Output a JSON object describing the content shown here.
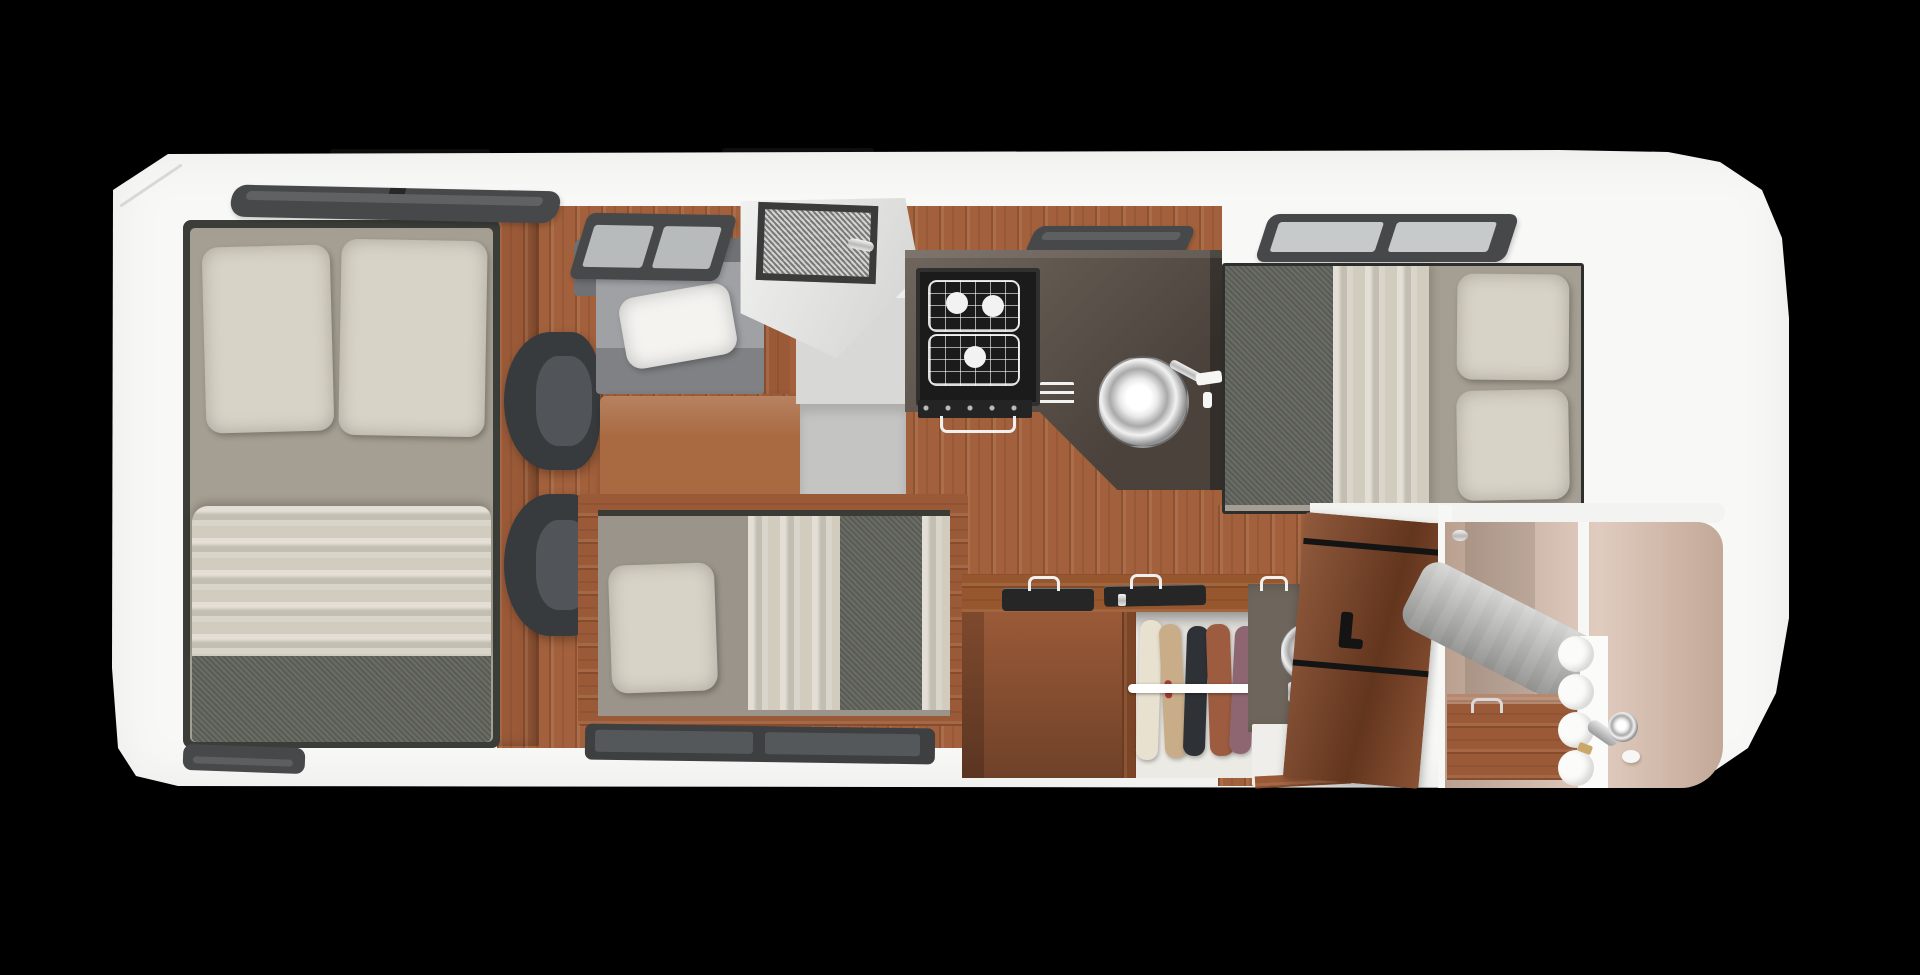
{
  "scene": {
    "description": "Top-down 3D rendered floor plan of a Class-C RV motorhome interior on a black background",
    "vehicle": "rv-motorhome-floorplan",
    "rooms": [
      {
        "name": "master-bedroom",
        "contains": [
          "double-bed",
          "two-pillows",
          "duvet",
          "blanket",
          "wood-partition",
          "window"
        ]
      },
      {
        "name": "dinette-lounge",
        "contains": [
          "sofa-bench",
          "white-pillow",
          "wood-table",
          "two-armchairs",
          "window"
        ]
      },
      {
        "name": "entry",
        "contains": [
          "entry-door",
          "screen-window",
          "door-handle",
          "step-well"
        ]
      },
      {
        "name": "kitchen",
        "contains": [
          "l-shaped-counter",
          "three-burner-stove",
          "oven-handle",
          "towel-rack",
          "round-sink",
          "faucet",
          "window"
        ]
      },
      {
        "name": "rear-bedroom",
        "contains": [
          "double-bed",
          "two-pillows",
          "duvet",
          "blanket",
          "window"
        ]
      },
      {
        "name": "sofa-bed-nook",
        "contains": [
          "single-bed",
          "pillow",
          "duvet",
          "blanket",
          "wood-frame",
          "window"
        ]
      },
      {
        "name": "storage",
        "contains": [
          "counter-block",
          "two-storage-trays",
          "wire-handles",
          "wardrobe",
          "clothes-rod",
          "five-garments"
        ]
      },
      {
        "name": "toilet-room",
        "contains": [
          "chrome-toilet",
          "white-floor",
          "wood-door",
          "door-handle"
        ]
      },
      {
        "name": "shower-room",
        "contains": [
          "beige-walls",
          "white-divider",
          "accordion-curtain",
          "gray-towel",
          "shower-head",
          "hose",
          "soap",
          "wood-cabinet"
        ]
      }
    ]
  },
  "palette": {
    "background": "#000000",
    "body_white": "#f8f8f7",
    "roof_bar": "#0e0e0e",
    "cab_edge": "#d8d8d6",
    "window_frame_dark": "#46484a",
    "window_frame_black": "#3d3f41",
    "window_pane_light": "#b7bbbc",
    "window_pane_bright": "#c6cacb",
    "window_glass_mid": "#55585a",
    "floor_wood": "#a2613c",
    "counter_wood": "#96572f",
    "cabinet_wood": "#9a5a38",
    "cabinet_wood_dark": "#7c4527",
    "table_wood": "#a96a42",
    "door_wood": "#834727",
    "counter_taupe": "#5f554b",
    "backsplash_dark": "#3e3933",
    "stove_black": "#1b1b1b",
    "stove_frame": "#303030",
    "oven_panel": "#242424",
    "burner_white": "#f2f2f2",
    "tray_black": "#262626",
    "pillow_cream": "#d8d3c7",
    "sheet_taupe": "#a59e92",
    "duvet_cream": "#d2ccbf",
    "blanket_gray": "#62645d",
    "bed_trim_dark": "#3b3d39",
    "single_bed_sheet": "#9a948a",
    "sofa_gray": "#94969a",
    "sofa_back_gray": "#6f7174",
    "sofa_pillow_white": "#f4f3f0",
    "chair_dark": "#383b3d",
    "chair_seat": "#51555a",
    "step_light": "#d8d8d7",
    "step_mid": "#c4c4c3",
    "door_light": "#e4e4e3",
    "screen_frame": "#3b3b3b",
    "screen_speckle": "#a7a7a5",
    "ledge_white": "#f3f3f1",
    "closet_interior": "#eceae5",
    "rod_white": "#ffffff",
    "toilet_wall": "#6e655c",
    "floor_white": "#f0eeeb",
    "shower_wall": "#d3b6a4",
    "divider_white": "#f7f7f5",
    "curtain_white": "#fbfbfa",
    "towel_gray": "#b9b9b7",
    "gold_fitting": "#c9a86a",
    "soap_white": "#f6f6f4",
    "trim_black": "#141414"
  },
  "closet": {
    "garments": [
      {
        "name": "cream-garment",
        "color": "#e9e1cf"
      },
      {
        "name": "tan-garment",
        "color": "#c9ad88"
      },
      {
        "name": "black-garment",
        "color": "#2e3135"
      },
      {
        "name": "rust-garment",
        "color": "#9d5c3f"
      },
      {
        "name": "mauve-garment",
        "color": "#8e6672"
      }
    ],
    "accent_stripe": "#a33b38"
  },
  "stove": {
    "burner_count": 3
  },
  "windows": {
    "count": 7
  }
}
